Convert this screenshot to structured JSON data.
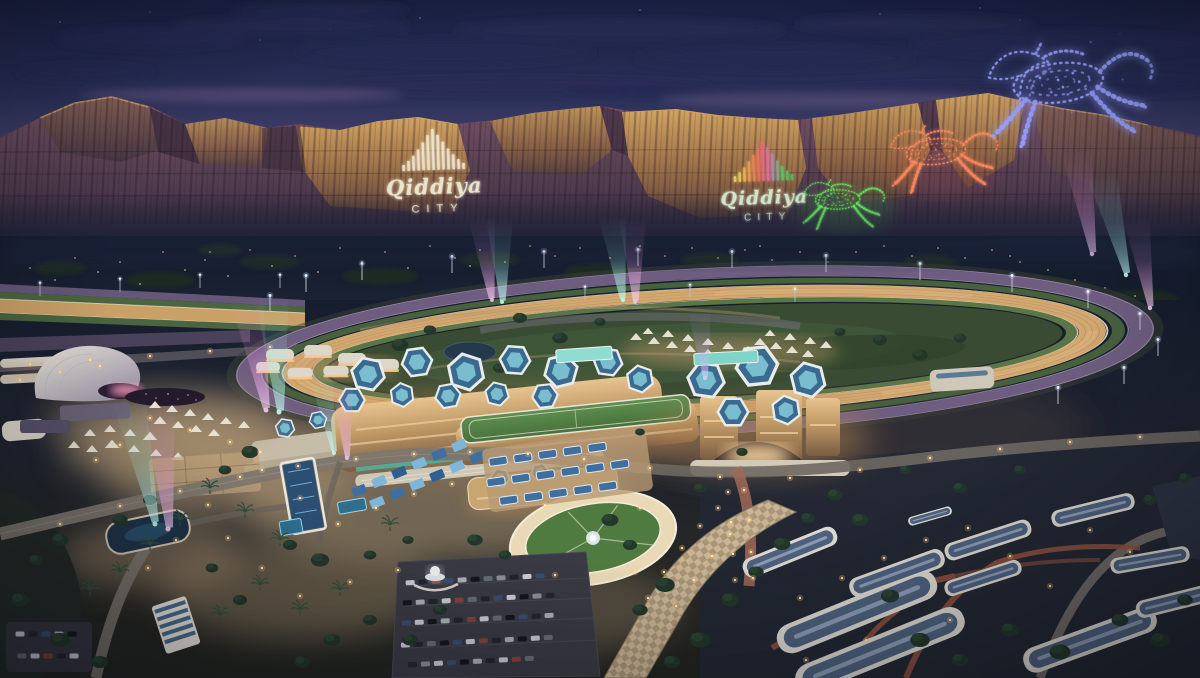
{
  "scene": {
    "name": "Qiddiya City equestrian district at dusk",
    "description": "Aerial rendering: illuminated horse-racing oval, hexagon-roofed grandstands, festival grounds, stables, and cliff light projections"
  },
  "cliff_projections": {
    "left_logo": {
      "brand": "Qiddiya",
      "sub": "CITY"
    },
    "right_logo": {
      "brand": "Qiddiya",
      "sub": "CITY"
    }
  },
  "light_art": {
    "green_horse": "green galloping horse projection",
    "red_horse": "red galloping horse projection",
    "blue_horse": "blue particle horse sculpture above ridge"
  },
  "palette": {
    "sky_top": "#191f40",
    "sky_horizon": "#8d7898",
    "cloud": "#242a52",
    "cliff_lit": "#c99a60",
    "cliff_shadow": "#4a3950",
    "track_purple": "#6e5d80",
    "track_dirt": "#d2a770",
    "track_rail": "#f2e6cc",
    "infield_green": "#394b33",
    "verge_green": "#47603e",
    "roof_blue": "#3b6a90",
    "roof_teal": "#7cc2d2",
    "facade_gold": "#c09a66",
    "screen_teal": "#8fdcd0",
    "beam_cyan": "#9ff0e8",
    "beam_magenta": "#f09ae8",
    "beam_violet": "#b89af0",
    "horse_green": "#66e85e",
    "horse_red": "#ff8a5e",
    "horse_blue": "#96a0ff",
    "lamp_warm": "#ffdca6",
    "stable_roof": "#4e617e",
    "path_red": "#96543f",
    "plaza_sand": "#b39a76"
  }
}
